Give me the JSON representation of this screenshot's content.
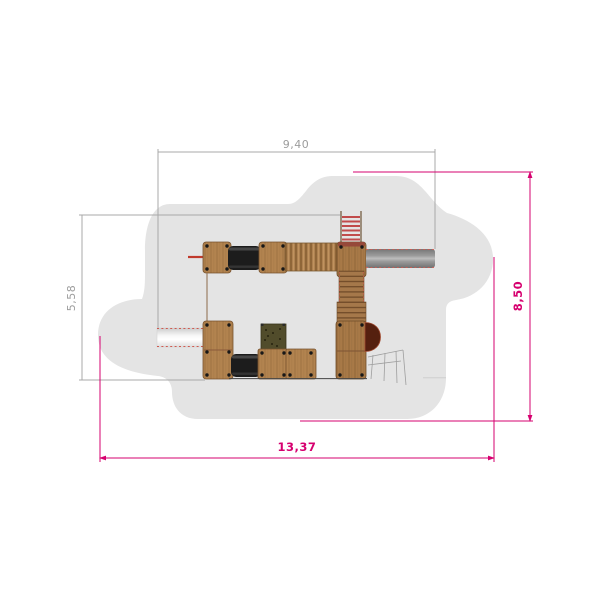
{
  "drawing": {
    "view": "top-view-plan",
    "dimensions": {
      "top": {
        "label": "9,40"
      },
      "left": {
        "label": "5,58"
      },
      "right": {
        "label": "8,50"
      },
      "bottom": {
        "label": "13,37"
      }
    },
    "colors": {
      "dimension_secondary": "#9c9c9c",
      "dimension_primary": "#d6006f",
      "safety_zone": "#e4e4e4",
      "wood": "#b2834f",
      "wood_dark": "#a87947",
      "tunnel": "#1c1c1c",
      "metal_slide": "#9b9b9b",
      "white_slide": "#f4f4f4",
      "ladder_rung": "#c14b4b",
      "climb_panel": "#514c2b",
      "crawl_exit": "#55200f"
    },
    "parts": [
      "safety-zone",
      "platform",
      "crawl-tunnel",
      "ribbed-bridge",
      "metal-slide",
      "white-slide",
      "wooden-stairs",
      "climbing-ladder",
      "climbing-panel",
      "crawl-exit",
      "rope-net",
      "fire-bar"
    ]
  }
}
